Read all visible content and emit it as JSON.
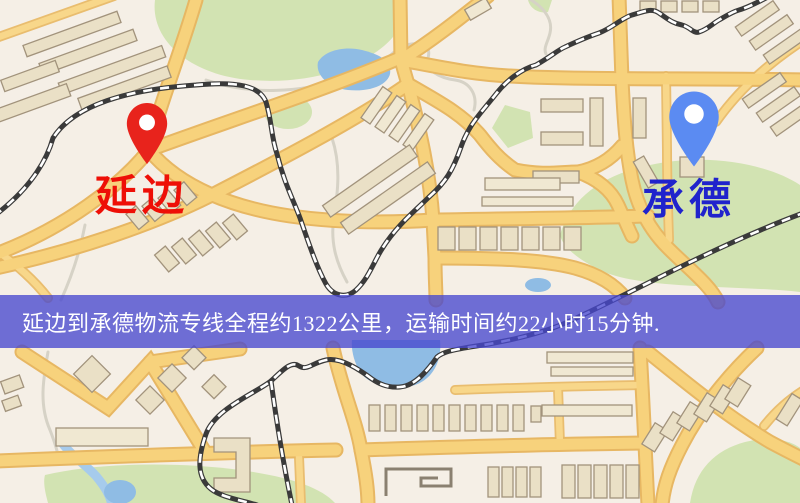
{
  "banner": {
    "text": "延边到承德物流专线全程约1322公里，运输时间约22小时15分钟."
  },
  "markers": {
    "origin": {
      "label": "延边",
      "pin_color": "#e8231c",
      "label_color": "#ee0f07",
      "pin_style": "red-teardrop"
    },
    "destination": {
      "label": "承德",
      "pin_color": "#5b8bf2",
      "label_color": "#2023cc",
      "pin_style": "blue-teardrop"
    }
  },
  "map_colors": {
    "background": "#f5efe6",
    "road_core": "#f7d27c",
    "road_casing": "#e7b763",
    "railway": "#3a3a3a",
    "park": "#d2e3b2",
    "water": "#8fbce4",
    "building": "#eae0c6",
    "banner_overlay": "#4848ce"
  }
}
